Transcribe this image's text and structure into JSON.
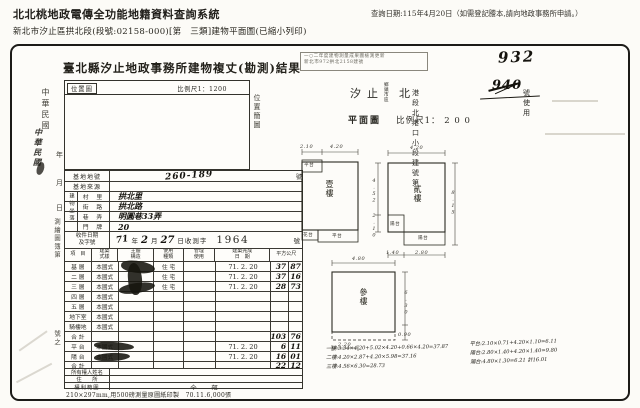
{
  "header": {
    "system_title": "北北桃地政電傳全功能地籍資料查詢系統",
    "query_date": "查詢日期:115年4月20日（如需登記謄本,請向地政事務所申請。）",
    "subtitle": "新北市汐止區拱北段(段號:02158-000)[第　三類]建物平面圖(已縮小列印)"
  },
  "doc": {
    "title": "臺北縣汐止地政事務所建物複丈(勘測)結果",
    "page_number": "932",
    "stamp_line1": "一○二年度建物測量成果圖檢測更新",
    "stamp_line2": "新北市972拱北2158建號",
    "loc_line": {
      "town1": "汐",
      "town2": "止",
      "unit_top": "鄉鎮",
      "unit_bottom": "市區",
      "sec_big": "北",
      "sec_rest": "港段北港口小段建號第",
      "struck_no": "940",
      "suffix": "號使用"
    },
    "plan_label": "平面圖",
    "plan_scale": "比例尺1：  2 0 0",
    "posbox": {
      "label": "位置圖",
      "scale": "比例尺1：1200",
      "side_stamp": "位置簡圖"
    },
    "margin": {
      "era1": "中華民國",
      "era2": "中華民國",
      "y": "年",
      "m": "月",
      "d": "日",
      "book": "測繪圖簿第",
      "no": "號之"
    },
    "footer": "210×297mm,用500磅測量原圖紙印製　70.11.6,000張"
  },
  "form": {
    "parcel": {
      "label": "基地地號",
      "value": "260-189",
      "suffix": "號"
    },
    "source_label": "基地來源",
    "site_group": "建物坐落",
    "site_rows": [
      {
        "label": "村　里",
        "value": "拱北里"
      },
      {
        "label": "街　路",
        "value": "拱北路"
      },
      {
        "label": "巷　弄",
        "value": "明圓巷33弄"
      },
      {
        "label": "門　牌",
        "value": "20"
      }
    ],
    "receipt": {
      "label1": "收件日期",
      "label2": "及字號",
      "hw_year": "71",
      "year": "年",
      "hw_month": "2",
      "month": "月",
      "hw_day": "27",
      "day": "日收測字",
      "number": "1964",
      "suffix": "號"
    },
    "columns": [
      [
        "項　目"
      ],
      [
        "建築",
        "式樣"
      ],
      [
        "主體",
        "構造"
      ],
      [
        "使用",
        "種類"
      ],
      [
        "管理",
        "使用"
      ],
      [
        "建築完成",
        "日　期"
      ],
      [
        "平方公尺"
      ]
    ],
    "rows": [
      {
        "floor": "基 層",
        "style": "本國式",
        "use": "住 宅",
        "date": "71. 2. 20",
        "a1": "37",
        "a2": "87",
        "stamp": true
      },
      {
        "floor": "二 層",
        "style": "本國式",
        "use": "住 宅",
        "date": "71. 2. 20",
        "a1": "37",
        "a2": "16",
        "stamp": true
      },
      {
        "floor": "三 層",
        "style": "本國式",
        "use": "住 宅",
        "date": "71. 2. 20",
        "a1": "28",
        "a2": "73",
        "stamp": true
      },
      {
        "floor": "四 層",
        "style": "本國式",
        "use": "",
        "date": "",
        "a1": "",
        "a2": ""
      },
      {
        "floor": "五 層",
        "style": "本國式",
        "use": "",
        "date": "",
        "a1": "",
        "a2": ""
      },
      {
        "floor": "地下室",
        "style": "本國式",
        "use": "",
        "date": "",
        "a1": "",
        "a2": ""
      },
      {
        "floor": "騎樓地",
        "style": "本國式",
        "use": "",
        "date": "",
        "a1": "",
        "a2": ""
      },
      {
        "floor": "合 計",
        "style": "",
        "use": "",
        "date": "",
        "a1": "103",
        "a2": "76"
      },
      {
        "floor": "平 台",
        "style": "本國式",
        "use": "",
        "date": "71. 2. 20",
        "a1": "6",
        "a2": "11",
        "stamp": true
      },
      {
        "floor": "陽 台",
        "style": "本國式",
        "use": "",
        "date": "71. 2. 20",
        "a1": "16",
        "a2": "01",
        "stamp": true
      },
      {
        "floor": "合 計",
        "style": "",
        "use": "",
        "date": "",
        "a1": "22",
        "a2": "12"
      }
    ],
    "owner": {
      "name_label": "所有權人姓名",
      "addr_label": "住　　所",
      "scope_label": "權利範圍",
      "scope_value": "全　部"
    }
  },
  "plan": {
    "floor1": {
      "label": "壹樓",
      "corner": "平台",
      "strip": "平台",
      "box": "花台",
      "dim_a": "2.10",
      "dim_b": "4.20"
    },
    "floor2": {
      "label": "貳樓",
      "notch": "陽台",
      "strip": "陽台",
      "dim_top": "4.20",
      "dim_left_a": "4.52",
      "dim_left_b": "2.10",
      "dim_right": "8.15",
      "dim_bot_a": "1.40",
      "dim_bot_b": "2.80"
    },
    "floor3": {
      "label": "參樓",
      "dim_top": "4.80",
      "dim_right": "6.30",
      "dim_right_b": "0.90",
      "dim_bottom": "2.20"
    }
  },
  "calc": {
    "left": [
      "一樓:3.34×4.20+5.02×4.20+0.66×4.20=37.87",
      "二樓:4.20×2.87+4.20×5.98=37.16",
      "三樓:4.56×6.30=28.73"
    ],
    "right": [
      "平台:2.10×0.71+4.20×1.10=6.11",
      "陽台:2.80×1.40+4.20×1.40=9.80",
      "陽台:4.80×1.30=6.21 計16.01"
    ]
  }
}
